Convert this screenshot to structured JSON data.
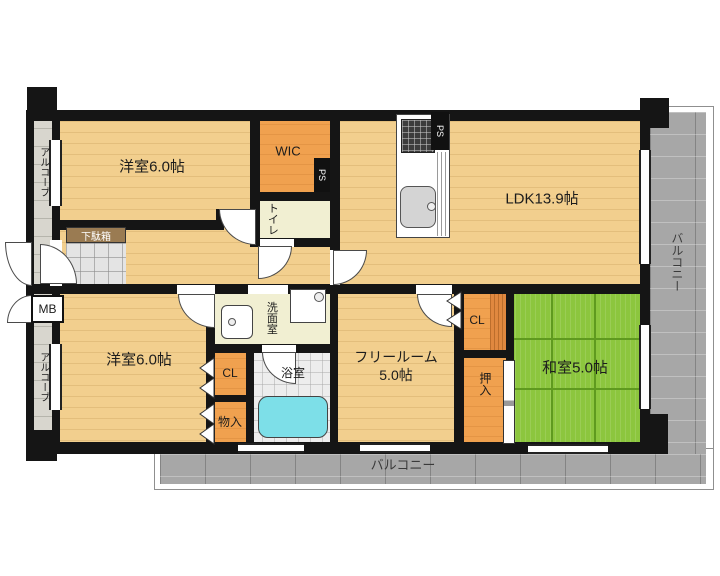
{
  "type": "real-estate-floor-plan",
  "labels": {
    "room1": "洋室6.0帖",
    "room2": "洋室6.0帖",
    "wic": "WIC",
    "ps": "PS",
    "toilet": "トイレ",
    "ldk": "LDK13.9帖",
    "getabako": "下駄箱",
    "alcove": "アルコーブ",
    "mb": "MB",
    "senmen": "洗面室",
    "cl": "CL",
    "bath": "浴室",
    "monoire": "物入",
    "freeroom_line1": "フリールーム",
    "freeroom_line2": "5.0帖",
    "oshiire": "押入",
    "washitsu": "和室5.0帖",
    "balcony": "バルコニー"
  },
  "colors": {
    "wood": "#f2cf8e",
    "accentwood": "#e0883f",
    "orange": "#f0a14f",
    "tatami": "#8cc63e",
    "tatamiline": "#5f9a1f",
    "pale": "#f1efd2",
    "bathfloor": "#ededed",
    "tub": "#7ddfe8",
    "balconygray": "#a7a7a7",
    "alcovegray": "#d8d6ce",
    "genkan": "#e4e4e4",
    "cabinet": "#9a7b52",
    "wall": "#151515",
    "text": "#1c1c1c"
  }
}
